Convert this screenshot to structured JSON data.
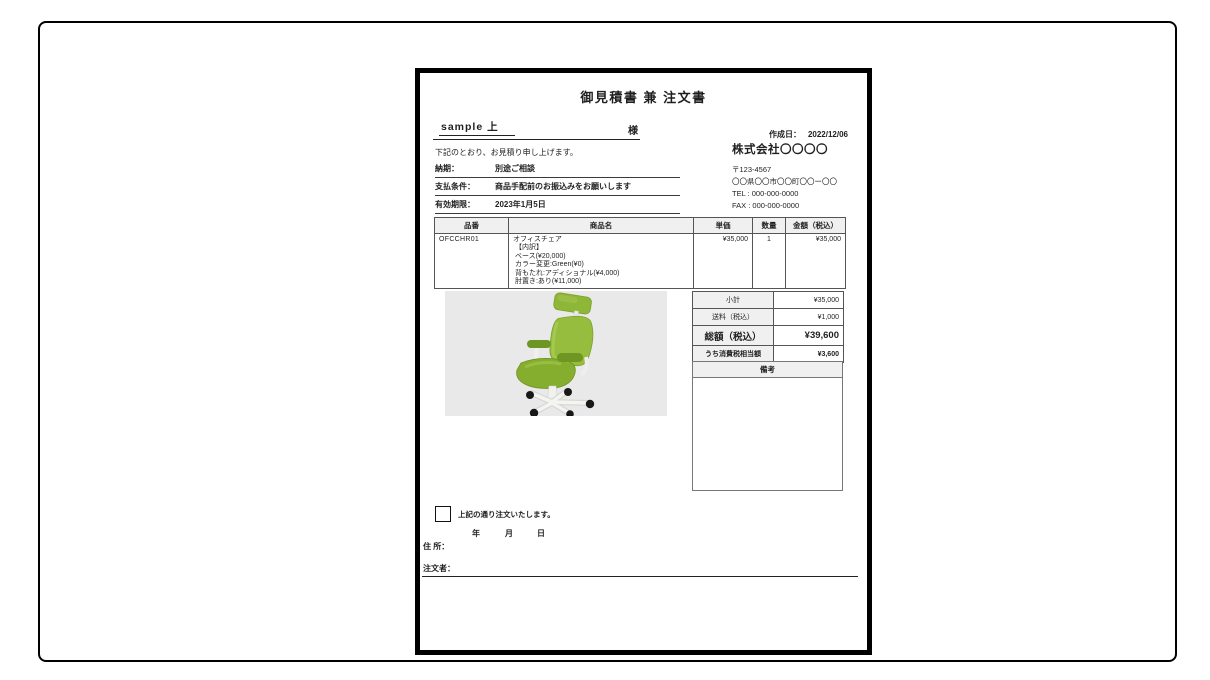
{
  "theme": {
    "header-fill": "#f0f0f0",
    "image-bg": "#e9e9e9",
    "chair-green": "#96bd3d",
    "chair-green-dark": "#6f9523",
    "chair-green-light": "#a8cc55"
  },
  "doc": {
    "title": "御見積書 兼 注文書",
    "customer_name": "sample 上",
    "honorific": "様",
    "created": {
      "label": "作成日：",
      "date": "2022/12/06"
    },
    "greeting": "下記のとおり、お見積り申し上げます。",
    "terms": [
      {
        "label": "納期：",
        "value": "別途ご相談"
      },
      {
        "label": "支払条件：",
        "value": "商品手配前のお振込みをお願いします"
      },
      {
        "label": "有効期限：",
        "value": "2023年1月5日"
      }
    ],
    "company": {
      "name": "株式会社〇〇〇〇",
      "postal": "〒123-4567",
      "address": "〇〇県〇〇市〇〇町〇〇ー〇〇",
      "tel": "TEL : 000-000-0000",
      "fax": "FAX : 000-000-0000"
    },
    "items_table": {
      "headers": [
        "品番",
        "商品名",
        "単価",
        "数量",
        "金額（税込）"
      ],
      "rows": [
        {
          "code": "OFCCHR01",
          "name_lines": [
            "オフィスチェア",
            " 【内訳】",
            " ベース(¥20,000)",
            " カラー変更:Green(¥0)",
            " 背もたれ:アディショナル(¥4,000)",
            " 肘置き:あり(¥11,000)"
          ],
          "unit_price": "¥35,000",
          "quantity": "1",
          "amount": "¥35,000"
        }
      ]
    },
    "totals": {
      "rows": [
        {
          "label": "小計",
          "value": "¥35,000"
        },
        {
          "label": "送料（税込）",
          "value": "¥1,000"
        },
        {
          "label": "総額（税込）",
          "value": "¥39,600"
        },
        {
          "label": "うち消費税相当額",
          "value": "¥3,600"
        }
      ]
    },
    "remarks_header": "備考",
    "order": {
      "checkbox_label": "上記の通り注文いたします。",
      "year_label": "年",
      "month_label": "月",
      "day_label": "日",
      "address_label": "住 所：",
      "orderer_label": "注文者："
    }
  }
}
